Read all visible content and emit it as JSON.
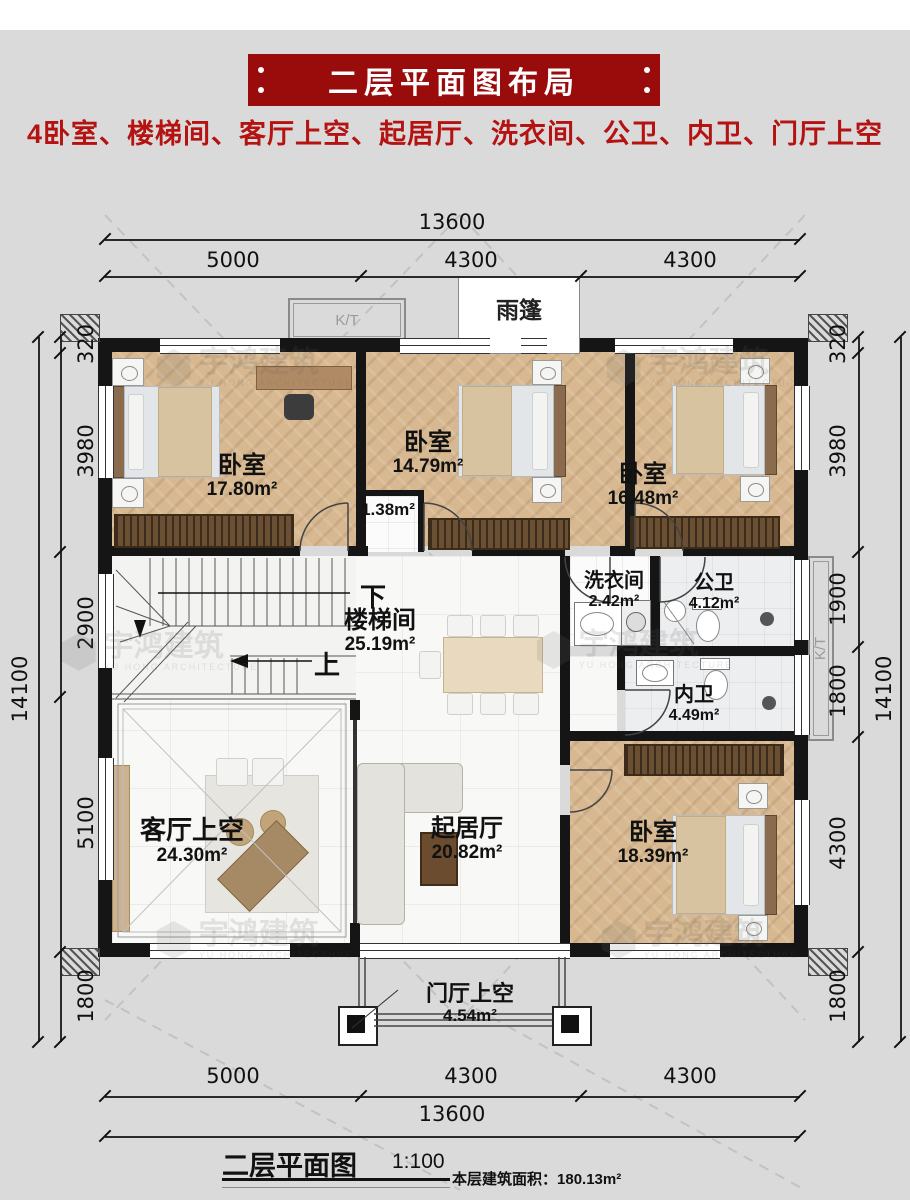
{
  "header": {
    "title": "二层平面图布局",
    "subtitle": "4卧室、楼梯间、客厅上空、起居厅、洗衣间、公卫、内卫、门厅上空"
  },
  "dimensions": {
    "top_total": "13600",
    "top_segments": [
      "5000",
      "4300",
      "4300"
    ],
    "bottom_segments": [
      "5000",
      "4300",
      "4300"
    ],
    "bottom_total": "13600",
    "left_segments": [
      "320",
      "3980",
      "2900",
      "5100",
      "1800"
    ],
    "left_total": "14100",
    "right_segments": [
      "320",
      "3980",
      "1900",
      "1800",
      "4300",
      "1800"
    ],
    "right_total": "14100"
  },
  "rooms": [
    {
      "name": "卧室",
      "area": "17.80m²"
    },
    {
      "name": "卧室",
      "area": "14.79m²"
    },
    {
      "name": "卧室",
      "area": "16.48m²"
    },
    {
      "name": "",
      "area": "1.38m²"
    },
    {
      "name": "楼梯间",
      "area": "25.19m²"
    },
    {
      "name": "洗衣间",
      "area": "2.42m²"
    },
    {
      "name": "公卫",
      "area": "4.12m²"
    },
    {
      "name": "内卫",
      "area": "4.49m²"
    },
    {
      "name": "客厅上空",
      "area": "24.30m²"
    },
    {
      "name": "起居厅",
      "area": "20.82m²"
    },
    {
      "name": "卧室",
      "area": "18.39m²"
    },
    {
      "name": "门厅上空",
      "area": "4.54m²"
    }
  ],
  "annotations": {
    "canopy": "雨篷",
    "kt_top": "K/T",
    "kt_right": "K/T",
    "stair_down": "下",
    "stair_up": "上"
  },
  "footer": {
    "title": "二层平面图",
    "scale": "1:100",
    "area_label": "本层建筑面积：",
    "area_value": "180.13m²"
  },
  "watermark": {
    "cn": "宇鸿建筑",
    "en": "YU HONG ARCHITECTURE"
  },
  "colors": {
    "banner_red": "#9a0b0b",
    "text_red": "#b51212",
    "wall_black": "#151515",
    "wood_floor": "#d7b890"
  }
}
